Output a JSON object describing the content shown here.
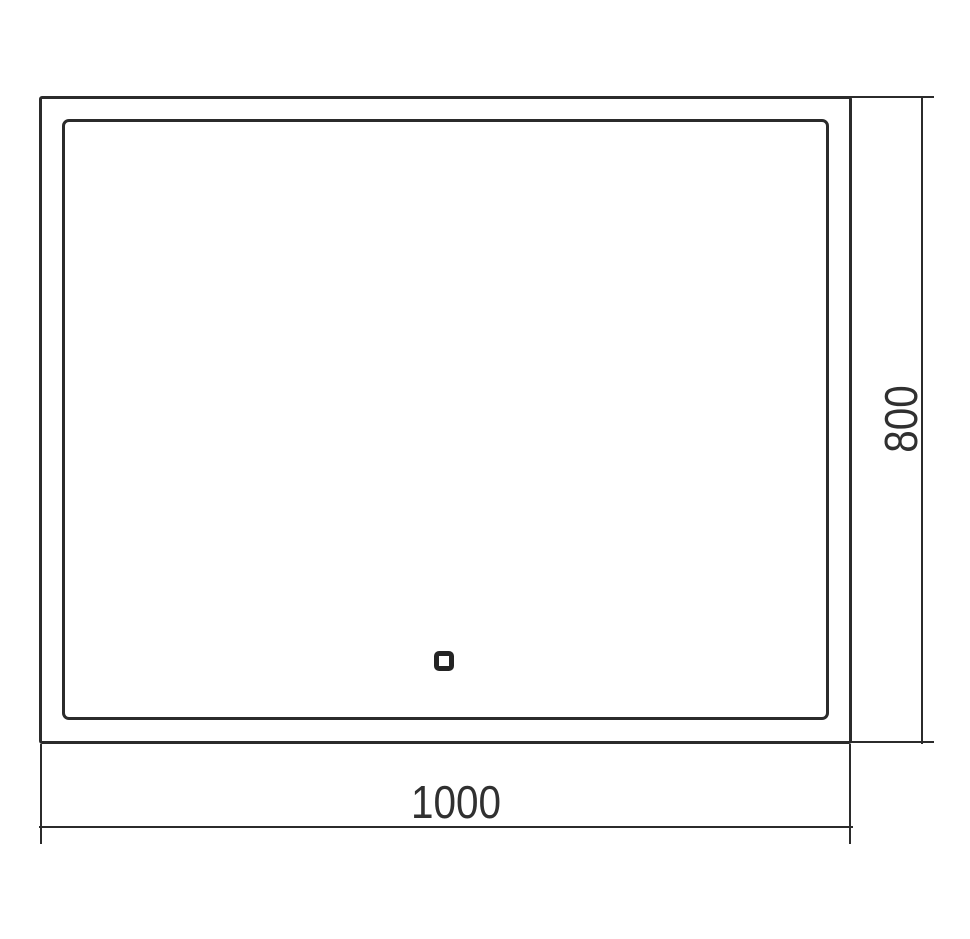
{
  "drawing": {
    "dimensions": {
      "width_label": "1000",
      "height_label": "800"
    }
  },
  "colors": {
    "line": "#2b2b2b",
    "background": "#ffffff",
    "text": "#303030"
  }
}
